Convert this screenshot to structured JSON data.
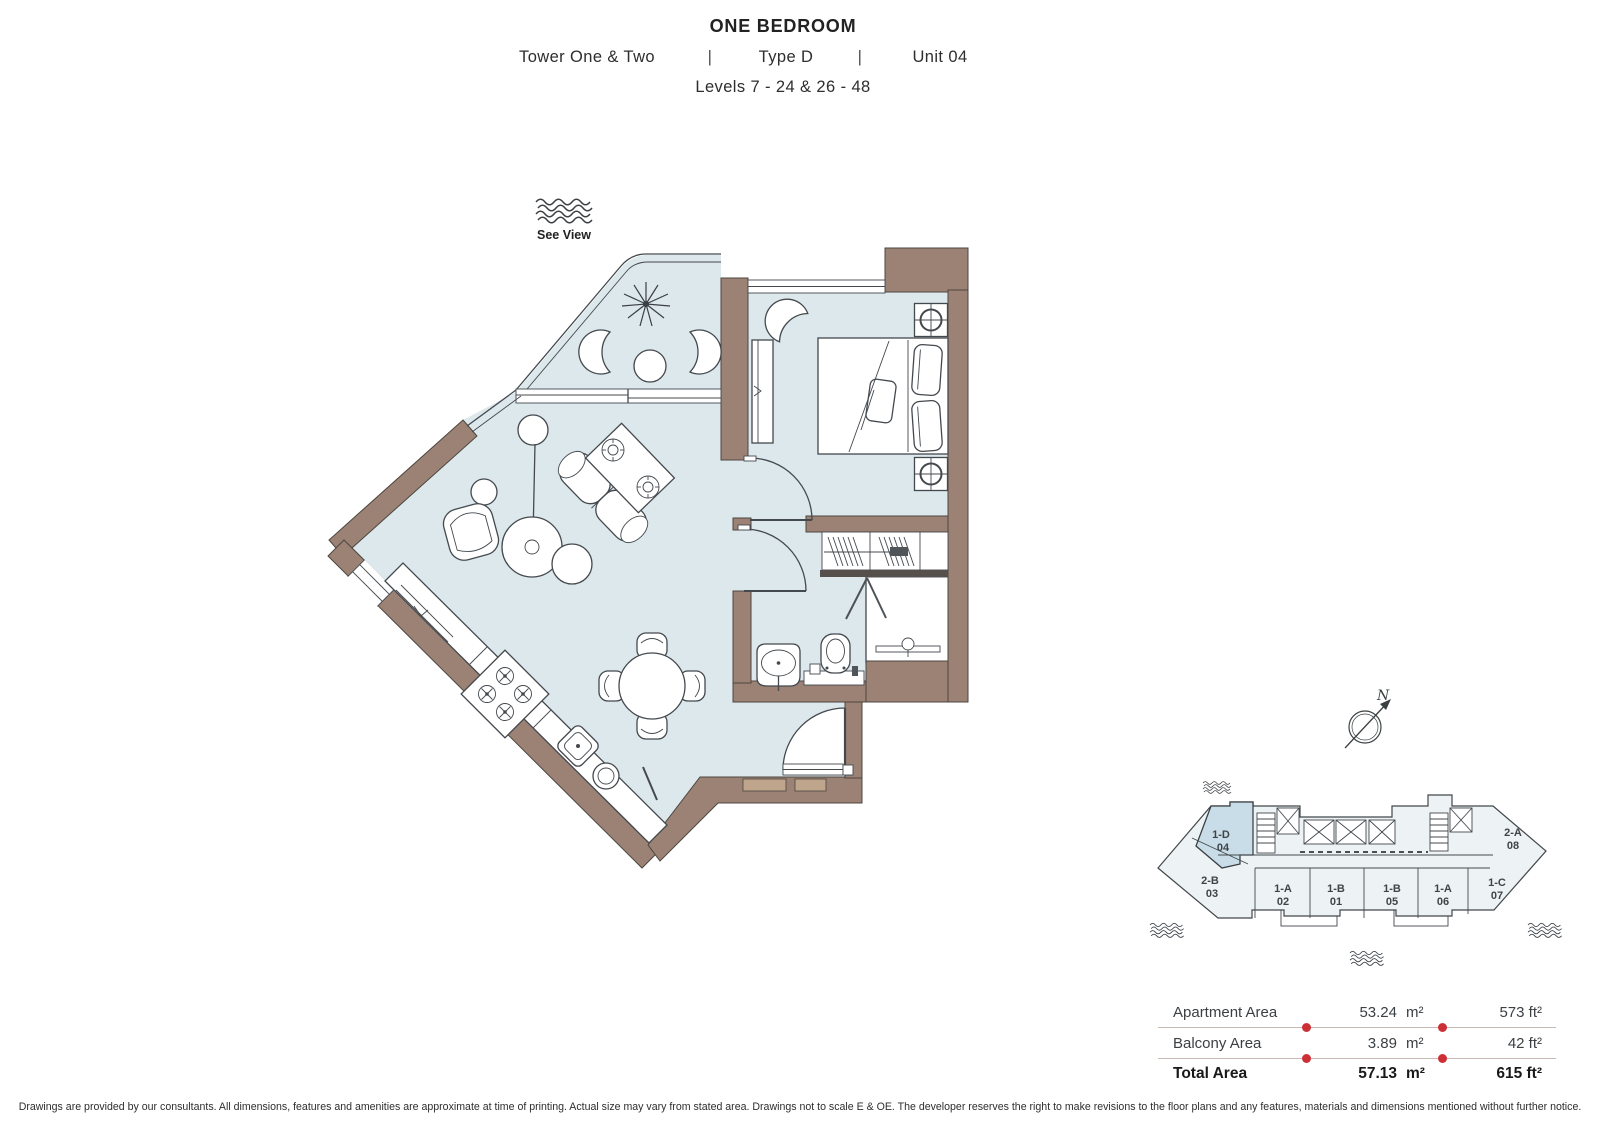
{
  "title": {
    "main": "ONE BEDROOM",
    "tower": "Tower One & Two",
    "pipe": "|",
    "type": "Type D",
    "unit": "Unit 04",
    "levels": "Levels 7 - 24 & 26 - 48"
  },
  "floor_plan": {
    "see_view_label": "See View",
    "compass_label": "N"
  },
  "key_plan": {
    "highlighted_unit": "1-D 04",
    "units": [
      {
        "code": "1-D",
        "num": "04",
        "highlighted": true
      },
      {
        "code": "2-B",
        "num": "03",
        "highlighted": false
      },
      {
        "code": "1-A",
        "num": "02",
        "highlighted": false
      },
      {
        "code": "1-B",
        "num": "01",
        "highlighted": false
      },
      {
        "code": "1-B",
        "num": "05",
        "highlighted": false
      },
      {
        "code": "1-A",
        "num": "06",
        "highlighted": false
      },
      {
        "code": "1-C",
        "num": "07",
        "highlighted": false
      },
      {
        "code": "2-A",
        "num": "08",
        "highlighted": false
      }
    ]
  },
  "area_table": {
    "rows": [
      {
        "label": "Apartment Area",
        "m2": "53.24",
        "m2_unit": "m²",
        "ft": "573 ft²"
      },
      {
        "label": "Balcony Area",
        "m2": "3.89",
        "m2_unit": "m²",
        "ft": "42 ft²"
      },
      {
        "label": "Total Area",
        "m2": "57.13",
        "m2_unit": "m²",
        "ft": "615 ft²"
      }
    ]
  },
  "disclaimer": "Drawings are provided by our consultants. All dimensions, features and amenities are approximate at time of printing.  Actual size may vary from stated area. Drawings not to scale E & OE. The developer reserves the right to make revisions to the floor plans and any features, materials and dimensions mentioned without further notice.",
  "colors": {
    "wall": "#9b8275",
    "floor": "#dce8ec",
    "line": "#44494e",
    "keyplan_fill": "#edf2f4",
    "keyplan_highlight": "#c9dde8",
    "accent_red": "#cc2f36",
    "threshold_tan": "#bfa58c"
  }
}
